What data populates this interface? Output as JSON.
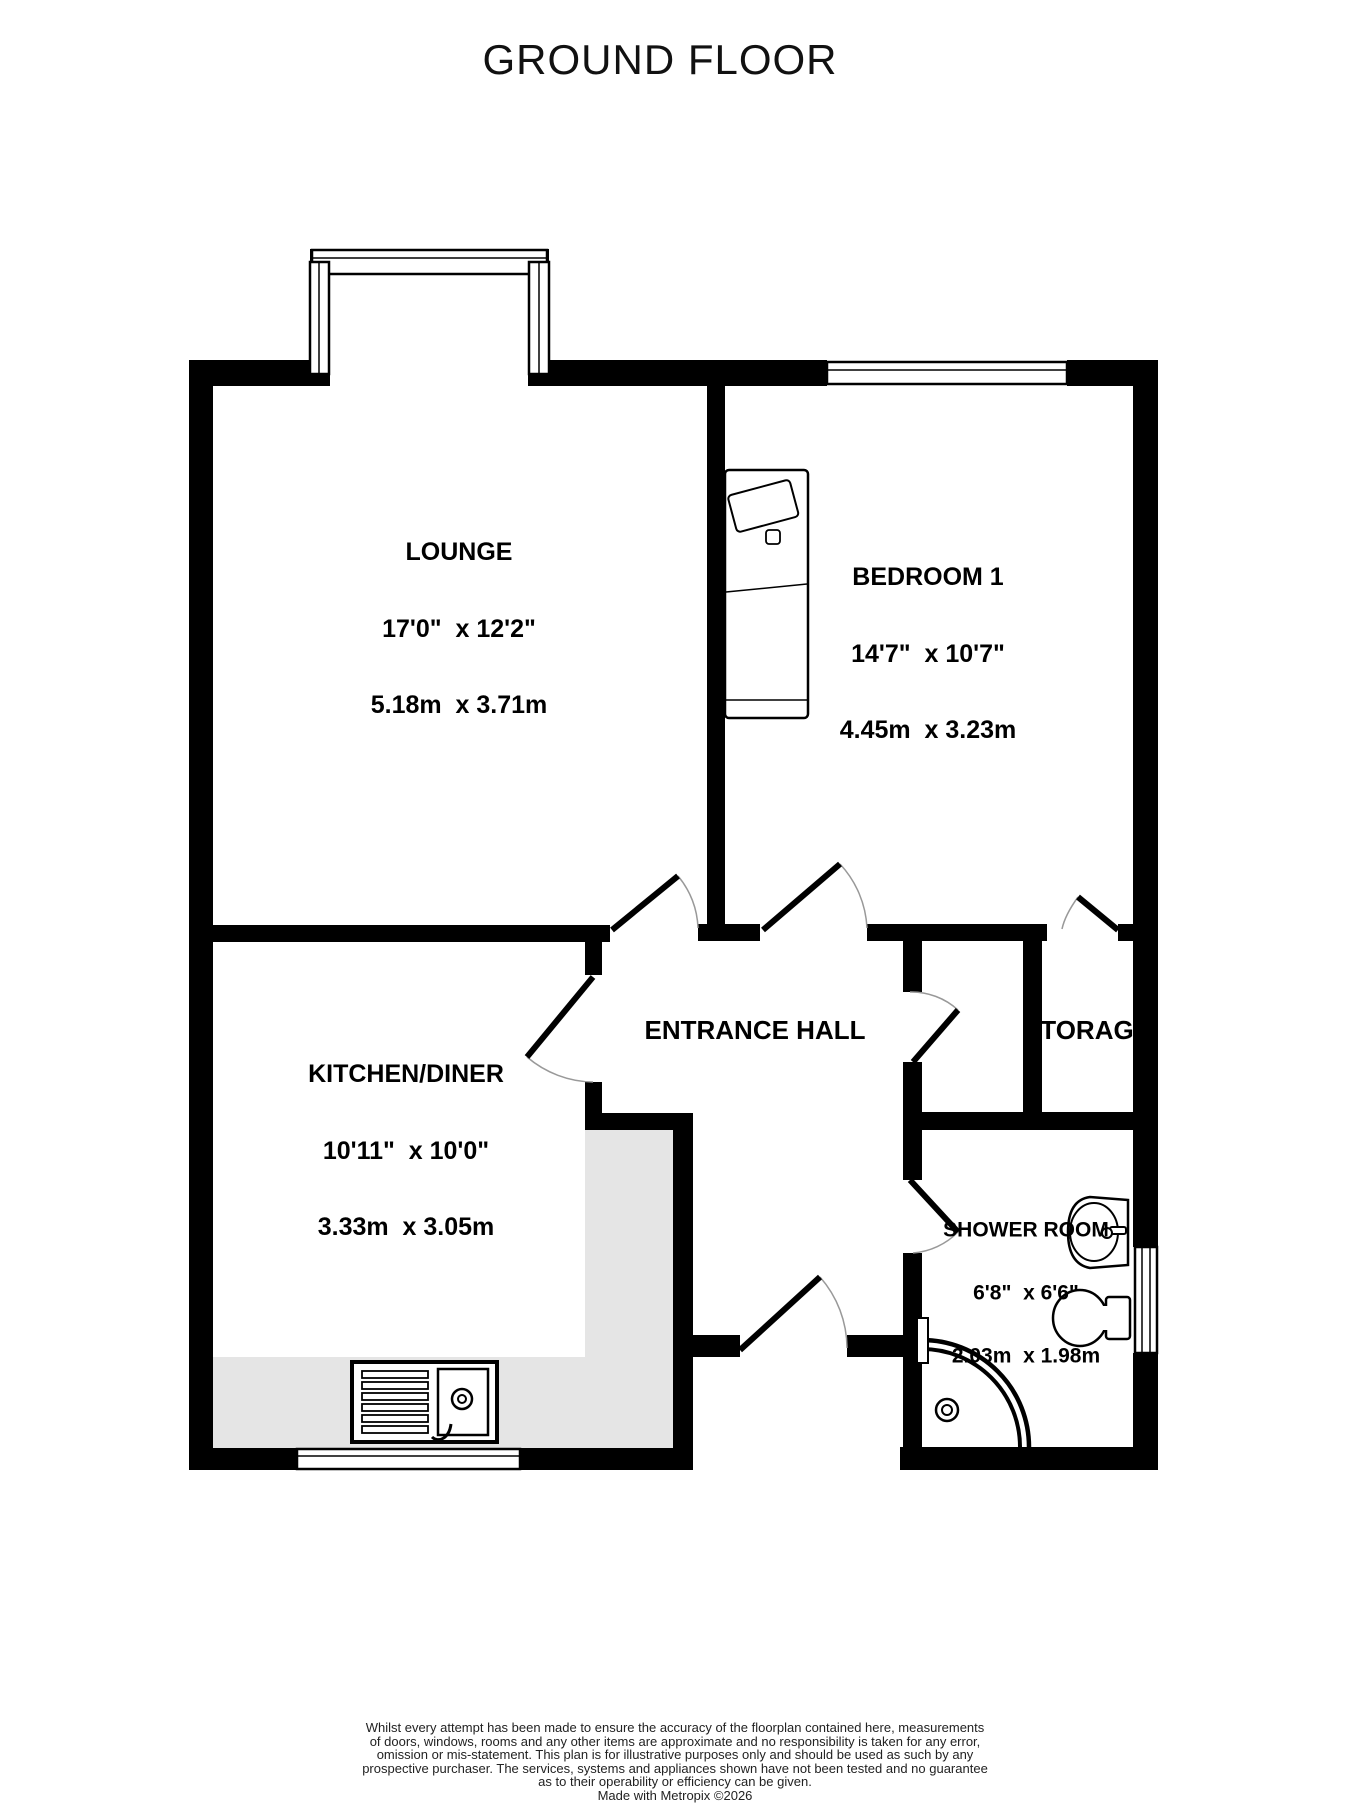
{
  "title": "GROUND FLOOR",
  "rooms": {
    "lounge": {
      "name": "LOUNGE",
      "imperial": "17'0\"  x 12'2\"",
      "metric": "5.18m  x 3.71m"
    },
    "bedroom1": {
      "name": "BEDROOM 1",
      "imperial": "14'7\"  x 10'7\"",
      "metric": "4.45m  x 3.23m"
    },
    "entrance_hall": {
      "name": "ENTRANCE HALL"
    },
    "kitchen_diner": {
      "name": "KITCHEN/DINER",
      "imperial": "10'11\"  x 10'0\"",
      "metric": "3.33m  x 3.05m"
    },
    "storage": {
      "name": "STORAGE"
    },
    "shower_room": {
      "name": "SHOWER ROOM",
      "imperial": "6'8\"  x 6'6\"",
      "metric": "2.03m  x 1.98m"
    }
  },
  "disclaimer": {
    "lines": [
      "Whilst every attempt has been made to ensure the accuracy of the floorplan contained here, measurements",
      "of doors, windows, rooms and any other items are approximate and no responsibility is taken for any error,",
      "omission or mis-statement. This plan is for illustrative purposes only and should be used as such by any",
      "prospective purchaser. The services, systems and appliances shown have not been tested and no guarantee",
      "as to their operability or efficiency can be given."
    ],
    "credit": "Made with Metropix ©2026"
  },
  "colors": {
    "wall": "#000000",
    "counter": "#e5e5e5",
    "arc": "#999999"
  }
}
